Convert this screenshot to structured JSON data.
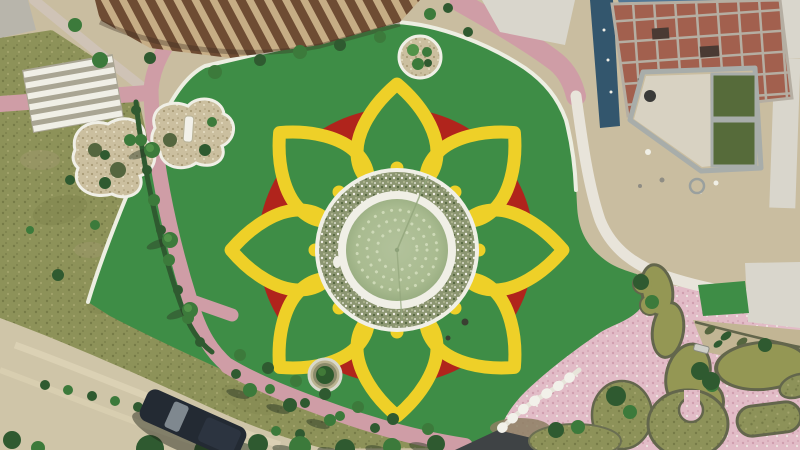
{
  "scene": {
    "type": "aerial-drone-photo",
    "description": "Top-down aerial photograph of a landscaped park: a circular fountain pool ringed by a planted flower bed sits at the center of a red circle decorated with eight yellow heart-shaped petals on bright green artificial turf; brick-pink paths, scrub islands and a stairway on the left; a construction site with a brick-slab building, scaffolding and two green water tanks at the top right; a free-form murky pond, pink paved plaza and grass mounds at the bottom right; natural grass, hedged paths, a dirt road and a parked dark car at the bottom left.",
    "flower": {
      "petal_count": 8,
      "petal_shape": "heart-outline",
      "petal_color_name": "yellow",
      "ring_color_name": "red",
      "fountain_dotted_rings": 3
    },
    "features": [
      {
        "name": "central-fountain-pool",
        "label": "circular pool with concentric fountain nozzle rings"
      },
      {
        "name": "planted-ring",
        "label": "annular flower bed around the pool"
      },
      {
        "name": "petal-mandala",
        "label": "eight yellow heart petals on a red circle"
      },
      {
        "name": "artificial-turf",
        "label": "bright green turf lawn"
      },
      {
        "name": "scrub-islands",
        "label": "white-edged planting islands"
      },
      {
        "name": "pergola",
        "label": "wooden slat pergola"
      },
      {
        "name": "construction-building",
        "label": "brick roof slab under construction"
      },
      {
        "name": "water-tanks",
        "label": "two green water tanks in concrete frame"
      },
      {
        "name": "pond",
        "label": "free-form green pond"
      },
      {
        "name": "pink-plaza",
        "label": "pink paved plaza with grass mounds"
      },
      {
        "name": "stairs",
        "label": "wide stairway"
      },
      {
        "name": "parked-car",
        "label": "dark car on dirt road"
      }
    ]
  },
  "colors": {
    "sand": "#c9bda0",
    "turf": "#3e8d46",
    "red": "#b0241c",
    "yellow": "#eed028",
    "white": "#f0efe6",
    "curb": "#edeee2",
    "veg": "#8c9671",
    "vegDark": "#55663f",
    "vegLight": "#aab28c",
    "water": "#abbc92",
    "waterEdge": "#96ab7f",
    "dots": "#cfdab8",
    "olive": "#8d9259",
    "oliveDark": "#767b47",
    "oliveLight": "#a3a46c",
    "road": "#cfc5a8",
    "roadLight": "#ddd3b6",
    "pink": "#cf9da6",
    "pinkLight": "#e0bcc1",
    "plaza": "#e2bcc7",
    "plazaDot": "#cf9fae",
    "murky": "#949754",
    "murkyDark": "#5f6147",
    "edge": "#63664c",
    "brick": "#a2604e",
    "beam": "#b5aea2",
    "holes": "#4a3a33",
    "pool": "#527795",
    "poolLight": "#7fa3b8",
    "scaffold": "#33566d",
    "structGray": "#a8adaa",
    "structFill": "#d8d2c2",
    "tank": "#566b3a",
    "concrete": "#d9d6cc",
    "gray": "#b8b5ab",
    "hedge": "#2f5a30",
    "bush": "#3c7a3b",
    "bushLight": "#529349",
    "shadow": "#2c3a26",
    "slatDark": "#6e4c33",
    "slatLight": "#c6ad85",
    "car": "#232a33",
    "carGlass": "#8f99a0",
    "scrubBase": "#cbbf9f",
    "scrubDark": "#a89a76",
    "scrubLight": "#e6ddc4",
    "benchWhite": "#f2f1ea",
    "canopy": "#3f4345",
    "dirtPatch": "#8d7f63",
    "boat": "#cfcfc8",
    "pathLight": "#cfc3b6"
  }
}
